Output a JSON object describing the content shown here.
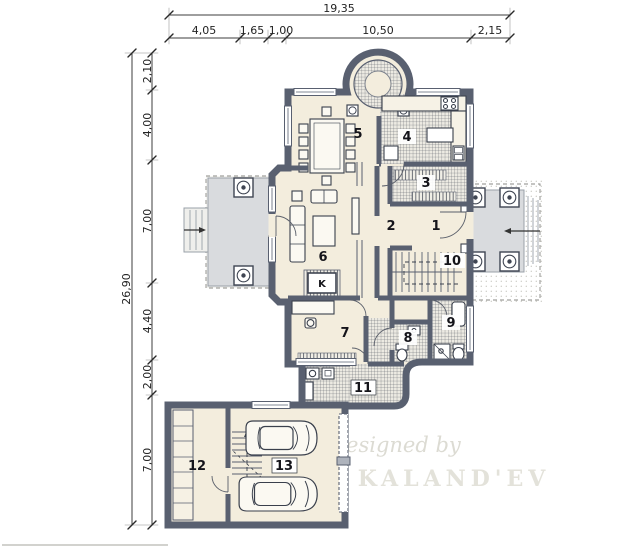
{
  "dimensions": {
    "top": {
      "total": "19,35",
      "segments": [
        "4,05",
        "1,65",
        "1,00",
        "10,50",
        "2,15"
      ]
    },
    "left": {
      "total": "26,90",
      "segments": [
        "2,10",
        "4,00",
        "7,00",
        "4,40",
        "2,00",
        "7,00"
      ]
    }
  },
  "rooms": {
    "r1": "1",
    "r2": "2",
    "r3": "3",
    "r4": "4",
    "r5": "5",
    "r6": "6",
    "r7": "7",
    "r8": "8",
    "r9": "9",
    "r10": "10",
    "r11": "11",
    "r12": "12",
    "r13": "13"
  },
  "labels": {
    "chimney": "K"
  },
  "watermark": {
    "line1": "Designed by",
    "line2": "TK KALAND'EV"
  },
  "colors": {
    "wall": "#596070",
    "floor": "#f3eddd",
    "terrace": "#d9dbde",
    "hatch_line": "#565b64",
    "dimension": "#232323"
  }
}
